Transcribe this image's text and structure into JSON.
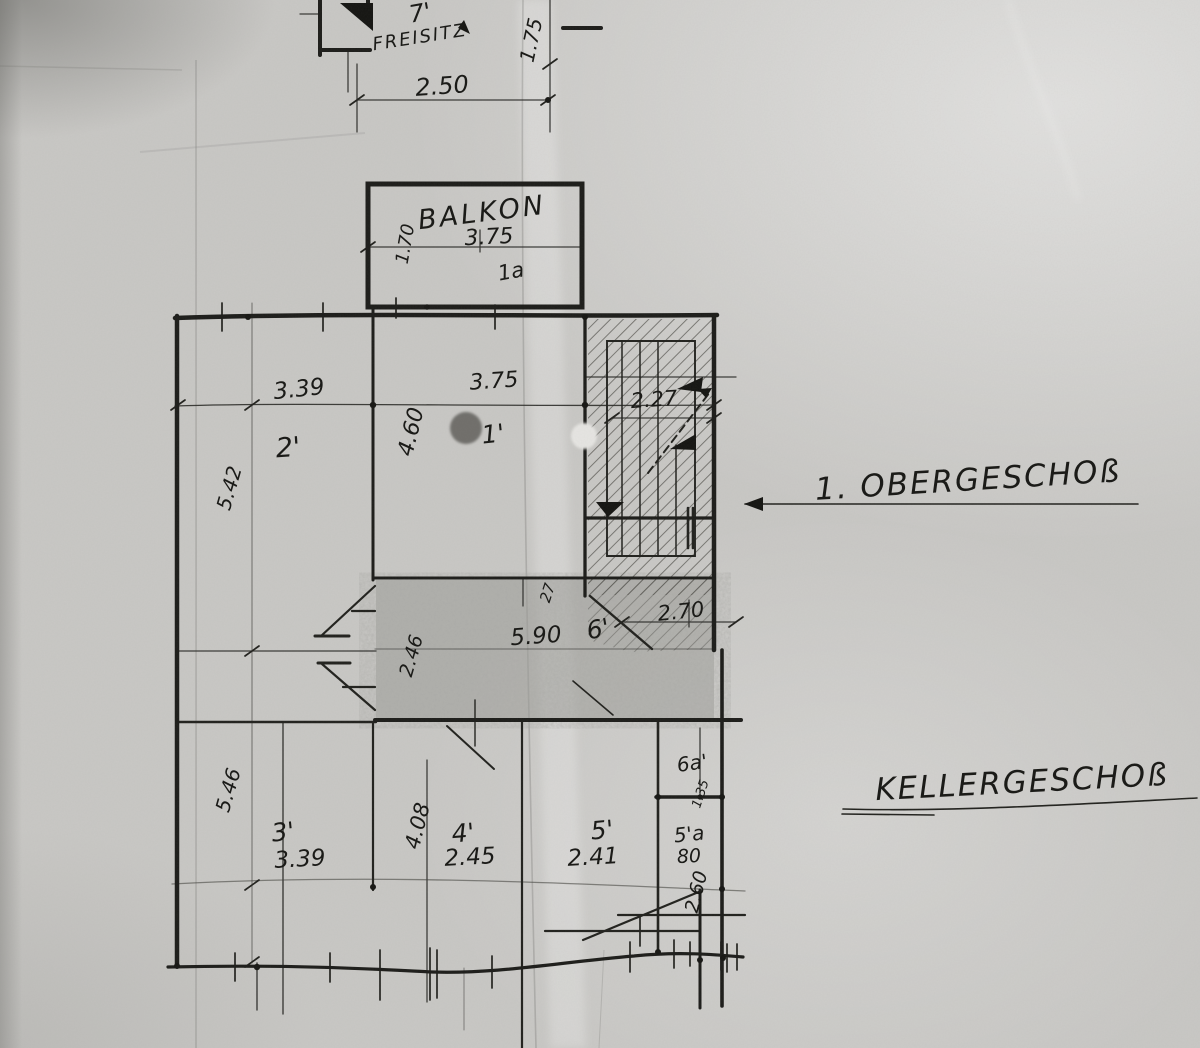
{
  "colors": {
    "ink": "#1c1c19",
    "paper": "#c9c8c5",
    "pencil_shading": "#8f8e8a",
    "hole_punch_dark": "#6f6e6b",
    "hole_punch_light": "#e6e5e2"
  },
  "plan": {
    "top_structure": {
      "room_number": "7'",
      "room_name": "FREISITZ",
      "width": "2.50",
      "side": "1.75"
    },
    "balkon": {
      "name": "BALKON",
      "width": "3.75",
      "room_number": "1a",
      "depth": "1.70"
    },
    "obergeschoss": {
      "leader_label": "1. OBERGESCHOß",
      "dim_3_39": "3.39",
      "room_2": "2'",
      "dim_3_75": "3.75",
      "dim_4_60": "4.60",
      "room_1": "1'",
      "stair_width": "2.27",
      "height_left": "5.42"
    },
    "mid_band": {
      "dim_27": "27",
      "dim_5_90": "5.90",
      "room_6": "6'",
      "dim_2_70": "2.70",
      "dim_2_46": "2.46"
    },
    "kellergeschoss": {
      "leader_label": "KELLERGESCHOß",
      "height_left": "5.46",
      "room_3": "3'",
      "dim_3_39": "3.39",
      "dim_4_08": "4.08",
      "room_4": "4'",
      "dim_2_45": "2.45",
      "room_5": "5'",
      "dim_2_41": "2.41",
      "room_5a": "5'a",
      "dim_80": "80",
      "dim_2_60": "2.60",
      "room_6a": "6a'",
      "dim_1_35": "1.35"
    }
  }
}
